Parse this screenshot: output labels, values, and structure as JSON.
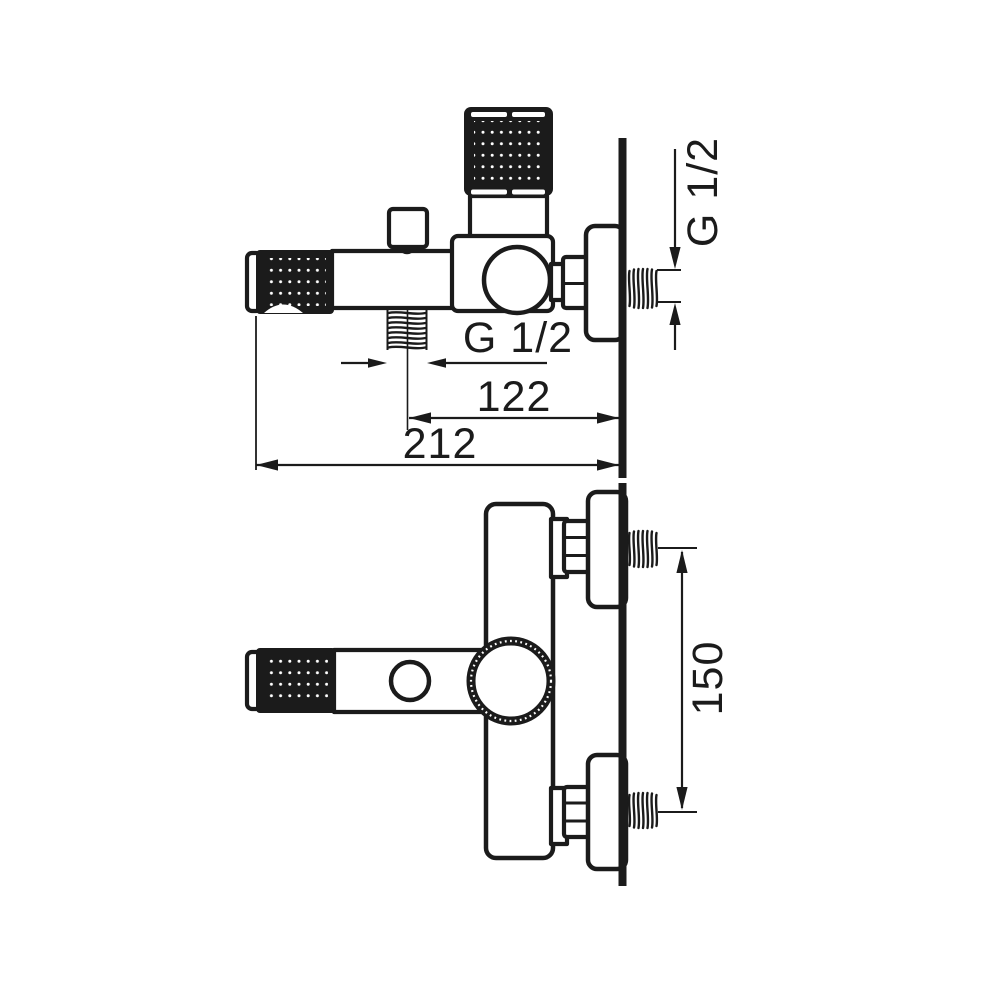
{
  "colors": {
    "line": "#1b1b1b",
    "background": "#ffffff",
    "handle_fill": "#1b1b1b"
  },
  "top_view": {
    "labels": {
      "outlet_thread": "G 1/2",
      "wall_thread": "G 1/2",
      "dim_outlet_to_wall": "122",
      "dim_total_depth": "212"
    }
  },
  "front_view": {
    "labels": {
      "dim_connection_spacing": "150"
    }
  }
}
